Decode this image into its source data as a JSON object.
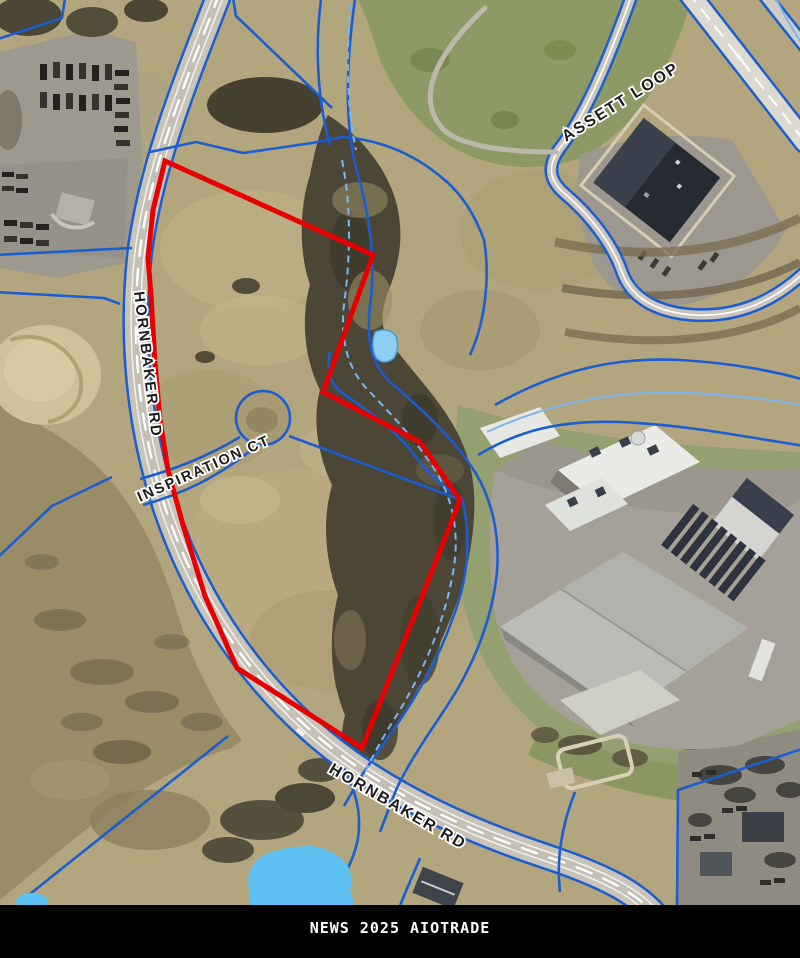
{
  "map": {
    "type": "aerial-parcel-map",
    "road_labels": [
      {
        "id": "hornbaker-left",
        "text": "HORNBAKER RD"
      },
      {
        "id": "inspiration-ct",
        "text": "INSPIRATION CT"
      },
      {
        "id": "assett-loop",
        "text": "ASSETT LOOP"
      },
      {
        "id": "hornbaker-bottom",
        "text": "HORNBAKER RD"
      }
    ],
    "colors": {
      "parcel_highlight": "#e60000",
      "parcel_boundary_blue": "#1a5ed0",
      "stream_light_blue": "#7db5f0",
      "pond_water": "#63c4f2",
      "road_fill": "#c8c4b9",
      "field_tan": "#b3a67e",
      "label_text": "#1c1c1c",
      "label_halo": "#ffffff"
    }
  },
  "footer": {
    "text": "NEWS 2025 AIOTRADE",
    "background": "#000000",
    "text_color": "#ffffff"
  }
}
